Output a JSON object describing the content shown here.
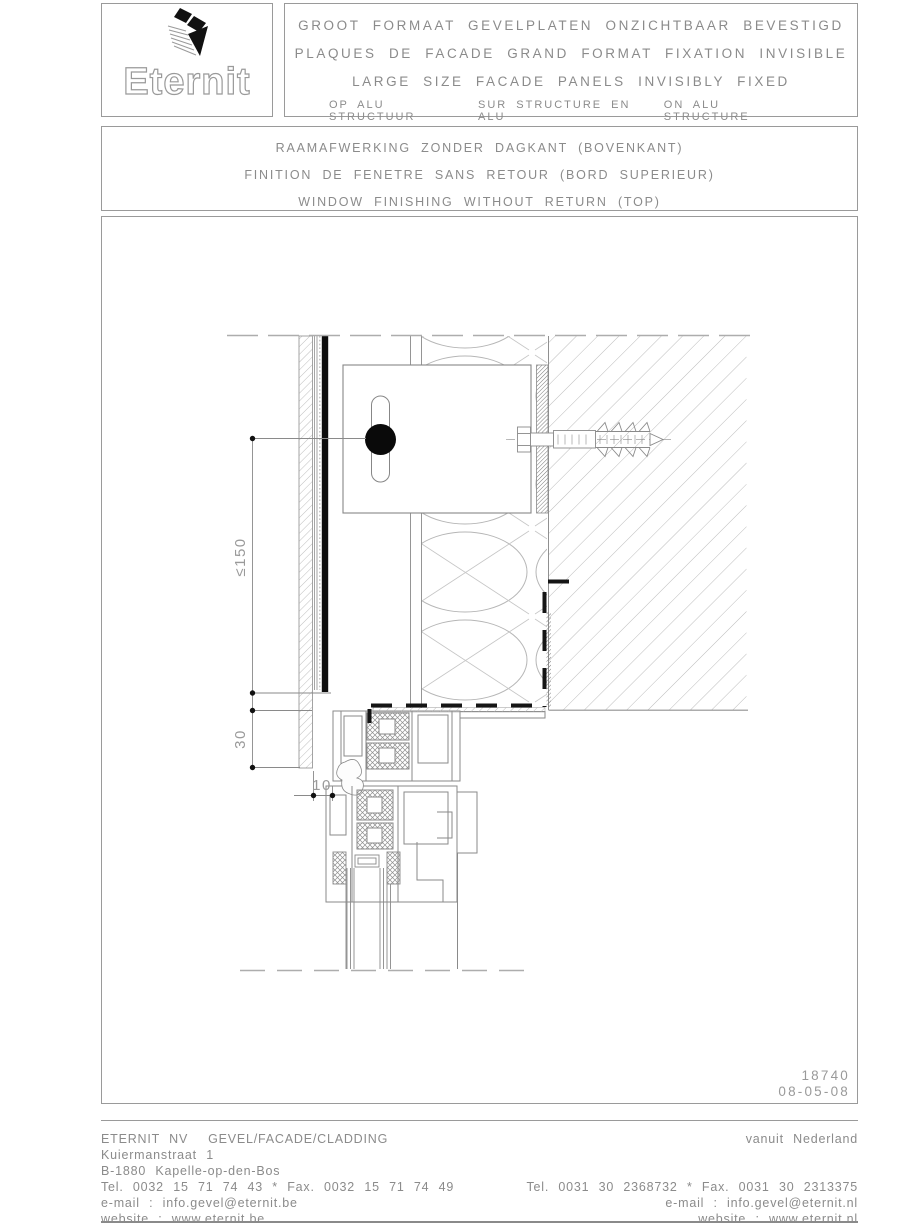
{
  "header": {
    "logo_text": "Eternit",
    "title_lines": [
      "GROOT FORMAAT GEVELPLATEN ONZICHTBAAR BEVESTIGD",
      "PLAQUES DE FACADE GRAND FORMAT FIXATION INVISIBLE",
      "LARGE SIZE FACADE PANELS INVISIBLY FIXED"
    ],
    "structure_labels": [
      "OP ALU STRUCTUUR",
      "SUR STRUCTURE EN ALU",
      "ON ALU STRUCTURE"
    ]
  },
  "subtitle": {
    "lines": [
      "RAAMAFWERKING ZONDER DAGKANT (BOVENKANT)",
      "FINITION DE FENETRE SANS RETOUR (BORD SUPERIEUR)",
      "WINDOW FINISHING WITHOUT RETURN (TOP)"
    ]
  },
  "drawing": {
    "number": "18740",
    "date": "08-05-08",
    "dimensions": {
      "max_height": "≤150",
      "overlap": "30",
      "gap": "10"
    }
  },
  "footer": {
    "left": {
      "company": "ETERNIT NV",
      "division": "GEVEL/FACADE/CLADDING",
      "address1": "Kuiermanstraat 1",
      "address2": "B-1880 Kapelle-op-den-Bos",
      "phone": "Tel. 0032 15 71 74 43 * Fax. 0032 15 71 74 49",
      "email": "e-mail : info.gevel@eternit.be",
      "website": "website : www.eternit.be"
    },
    "right": {
      "region": "vanuit Nederland",
      "phone": "Tel. 0031 30 2368732 * Fax. 0031 30 2313375",
      "email": "e-mail : info.gevel@eternit.nl",
      "website": "website : www.eternit.nl"
    }
  },
  "colors": {
    "line_gray": "#8c8c8c",
    "text_gray": "#8b8b8b",
    "hatch_gray": "#b8b8b8",
    "panel_black": "#0d0d0d"
  }
}
